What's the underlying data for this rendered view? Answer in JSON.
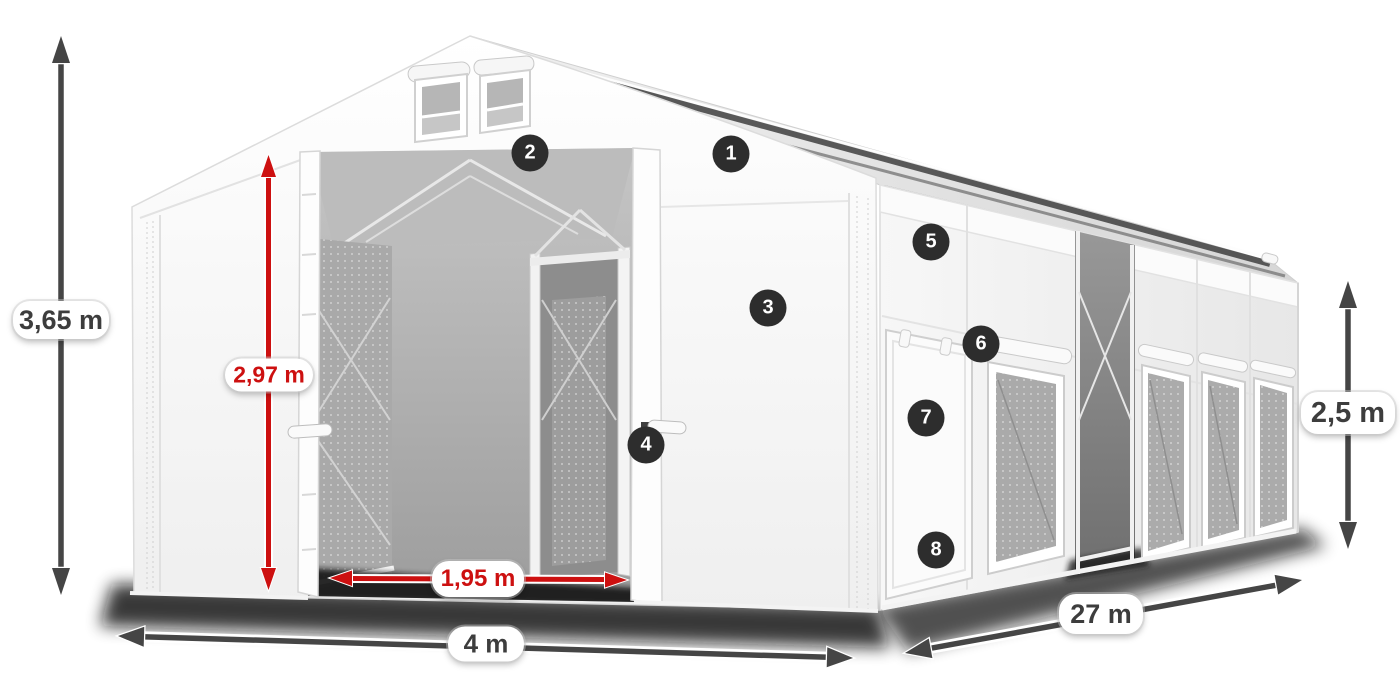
{
  "diagram": {
    "subject": "storage-tent-with-dimensions",
    "dimensions": {
      "total_height": {
        "label": "3,65 m"
      },
      "entrance_height": {
        "label": "2,97 m"
      },
      "entrance_width": {
        "label": "1,95 m"
      },
      "width": {
        "label": "4 m"
      },
      "length": {
        "label": "27 m"
      },
      "side_height": {
        "label": "2,5 m"
      }
    },
    "callouts": [
      {
        "number": "1"
      },
      {
        "number": "2"
      },
      {
        "number": "3"
      },
      {
        "number": "4"
      },
      {
        "number": "5"
      },
      {
        "number": "6"
      },
      {
        "number": "7"
      },
      {
        "number": "8"
      }
    ]
  },
  "colors": {
    "ink": "#3d3d3d",
    "red": "#cd1010",
    "arrow": "#454545",
    "callout_bg": "#2d2d2d",
    "callout_text": "#ffffff"
  }
}
